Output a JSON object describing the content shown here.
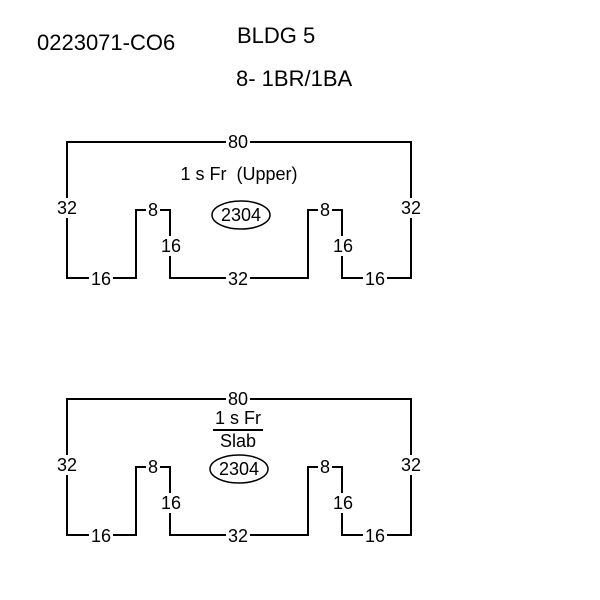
{
  "header": {
    "file_number": "0223071-CO6",
    "building_label": "BLDG 5",
    "units_label": "8- 1BR/1BA"
  },
  "colors": {
    "line": "#000000",
    "background": "#ffffff",
    "text": "#000000"
  },
  "sketches": [
    {
      "name": "upper-level",
      "caption": "1 s Fr  (Upper)",
      "area": "2304",
      "dims": {
        "top": "80",
        "left": "32",
        "right": "32",
        "notch_left_top": "8",
        "notch_right_top": "8",
        "notch_left_height": "16",
        "notch_right_height": "16",
        "bottom_left": "16",
        "bottom_center": "32",
        "bottom_right": "16"
      }
    },
    {
      "name": "ground-level",
      "caption_top": "1 s Fr",
      "caption_bottom": "Slab",
      "area": "2304",
      "dims": {
        "top": "80",
        "left": "32",
        "right": "32",
        "notch_left_top": "8",
        "notch_right_top": "8",
        "notch_left_height": "16",
        "notch_right_height": "16",
        "bottom_left": "16",
        "bottom_center": "32",
        "bottom_right": "16"
      }
    }
  ]
}
